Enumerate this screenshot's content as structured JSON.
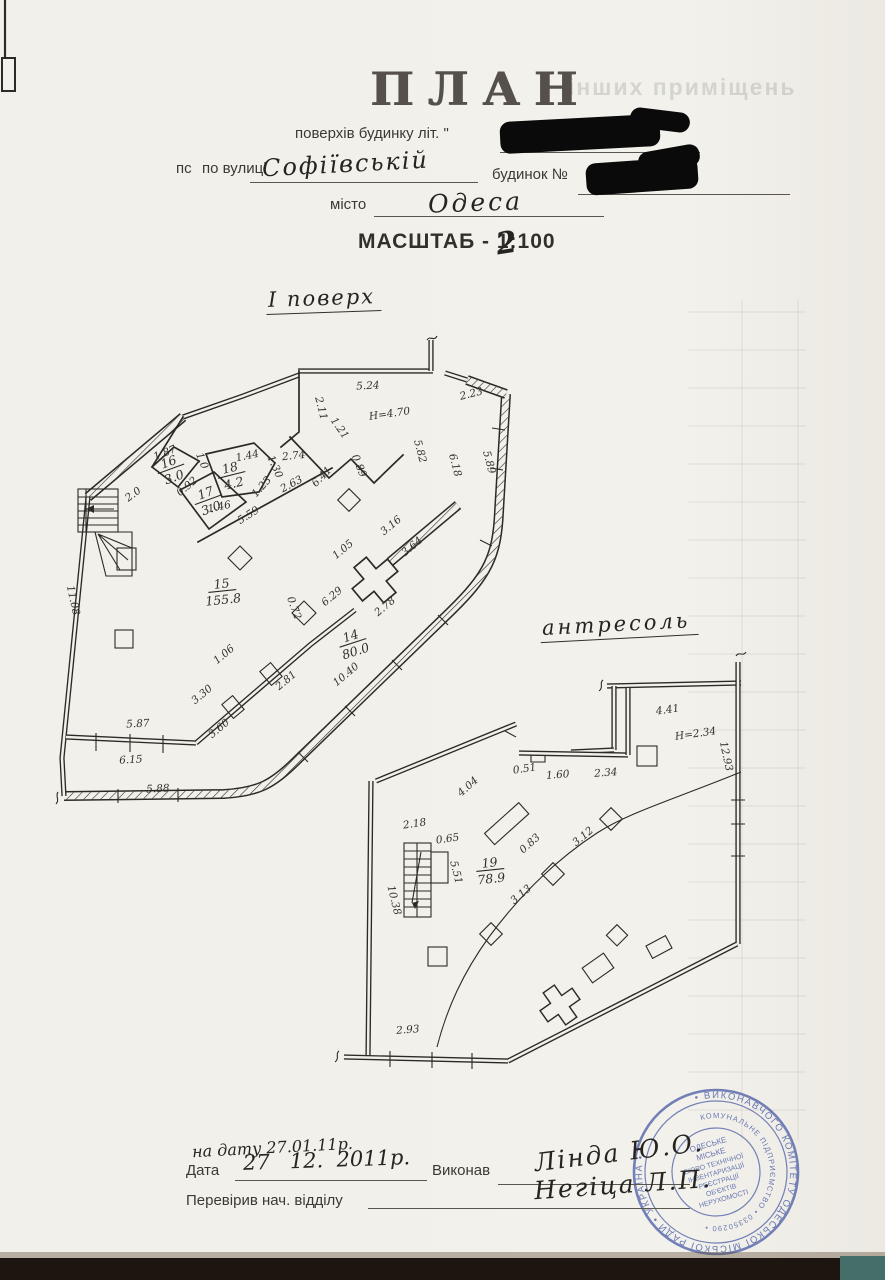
{
  "ink": "#2c2a26",
  "paper": "#f2f0ea",
  "header": {
    "title": "ПЛАН",
    "ghost_text": "інших приміщень",
    "line1_label": "поверхів будинку літ.  \"",
    "line2_prefix": "пс",
    "line2_label": "по вулиці",
    "street_value": "Софіївській",
    "line2_suffix": "будинок №",
    "line3_label": "місто",
    "city_value": "Одеса",
    "scale_prefix": "МАСШТАБ - 1:",
    "scale_digits": "100",
    "scale_overwrite": "2"
  },
  "plan1": {
    "caption": "І поверх",
    "height_note": "H=4.70",
    "labels": [
      {
        "t": "5.24",
        "x": 368,
        "y": 389,
        "r": -3
      },
      {
        "t": "H=4.70",
        "x": 390,
        "y": 417,
        "r": -8
      },
      {
        "t": "2.11",
        "x": 318,
        "y": 409,
        "r": 76
      },
      {
        "t": "1.21",
        "x": 337,
        "y": 430,
        "r": 55
      },
      {
        "t": "2.23",
        "x": 472,
        "y": 397,
        "r": -14
      },
      {
        "t": "5.82",
        "x": 417,
        "y": 452,
        "r": 75
      },
      {
        "t": "6.18",
        "x": 452,
        "y": 466,
        "r": 75
      },
      {
        "t": "5.89",
        "x": 486,
        "y": 463,
        "r": 75
      },
      {
        "t": "0.89",
        "x": 356,
        "y": 467,
        "r": 68
      },
      {
        "t": "2.74",
        "x": 294,
        "y": 459,
        "r": -6
      },
      {
        "t": "2.63",
        "x": 293,
        "y": 487,
        "r": -28
      },
      {
        "t": "6.41",
        "x": 324,
        "y": 479,
        "r": -46
      },
      {
        "t": "1.44",
        "x": 248,
        "y": 459,
        "r": -12
      },
      {
        "t": "1.23",
        "x": 264,
        "y": 489,
        "r": -48
      },
      {
        "t": "1.30",
        "x": 272,
        "y": 468,
        "r": 66
      },
      {
        "t": "1.87",
        "x": 166,
        "y": 456,
        "r": -22
      },
      {
        "t": "1.0",
        "x": 199,
        "y": 462,
        "r": 68
      },
      {
        "t": "0.92",
        "x": 189,
        "y": 489,
        "r": -40
      },
      {
        "t": "1.46",
        "x": 220,
        "y": 510,
        "r": -12
      },
      {
        "t": "5.59",
        "x": 250,
        "y": 518,
        "r": -32
      },
      {
        "t": "2.0",
        "x": 135,
        "y": 497,
        "r": -36
      },
      {
        "t": "3.16",
        "x": 393,
        "y": 528,
        "r": -40
      },
      {
        "t": "3.64",
        "x": 414,
        "y": 549,
        "r": -40
      },
      {
        "t": "1.05",
        "x": 345,
        "y": 552,
        "r": -40
      },
      {
        "t": "6.29",
        "x": 334,
        "y": 599,
        "r": -40
      },
      {
        "t": "0.72",
        "x": 291,
        "y": 609,
        "r": 70
      },
      {
        "t": "2.78",
        "x": 387,
        "y": 609,
        "r": -40
      },
      {
        "t": "1.06",
        "x": 226,
        "y": 657,
        "r": -40
      },
      {
        "t": "3.30",
        "x": 204,
        "y": 697,
        "r": -40
      },
      {
        "t": "3.60",
        "x": 221,
        "y": 731,
        "r": -40
      },
      {
        "t": "2.81",
        "x": 288,
        "y": 683,
        "r": -40
      },
      {
        "t": "10.40",
        "x": 348,
        "y": 677,
        "r": -40
      },
      {
        "t": "5.87",
        "x": 138,
        "y": 727,
        "r": -3
      },
      {
        "t": "6.15",
        "x": 131,
        "y": 763,
        "r": -3
      },
      {
        "t": "5.88",
        "x": 158,
        "y": 792,
        "r": -3
      },
      {
        "t": "11.08",
        "x": 70,
        "y": 601,
        "r": 78
      }
    ],
    "rooms": [
      {
        "num": "15",
        "area": "155.8",
        "x": 222,
        "y": 588,
        "r": -6
      },
      {
        "num": "14",
        "area": "80.0",
        "x": 352,
        "y": 640,
        "r": -18
      },
      {
        "num": "16",
        "area": "3.0",
        "x": 170,
        "y": 466,
        "r": -20
      },
      {
        "num": "18",
        "area": "4.2",
        "x": 231,
        "y": 472,
        "r": -14
      },
      {
        "num": "17",
        "area": "3.0",
        "x": 207,
        "y": 497,
        "r": -20
      }
    ]
  },
  "plan2": {
    "caption": "антресоль",
    "height_note": "H=2.34",
    "labels": [
      {
        "t": "4.41",
        "x": 668,
        "y": 713,
        "r": -8
      },
      {
        "t": "H=2.34",
        "x": 696,
        "y": 737,
        "r": -8
      },
      {
        "t": "12.93",
        "x": 723,
        "y": 757,
        "r": 78
      },
      {
        "t": "2.34",
        "x": 606,
        "y": 776,
        "r": -4
      },
      {
        "t": "1.60",
        "x": 558,
        "y": 778,
        "r": -4
      },
      {
        "t": "0.51",
        "x": 525,
        "y": 772,
        "r": -8
      },
      {
        "t": "4.04",
        "x": 470,
        "y": 789,
        "r": -42
      },
      {
        "t": "2.18",
        "x": 415,
        "y": 827,
        "r": -8
      },
      {
        "t": "0.65",
        "x": 448,
        "y": 842,
        "r": -8
      },
      {
        "t": "5.51",
        "x": 453,
        "y": 873,
        "r": 76
      },
      {
        "t": "10.38",
        "x": 391,
        "y": 901,
        "r": 76
      },
      {
        "t": "0.83",
        "x": 532,
        "y": 846,
        "r": -42
      },
      {
        "t": "3.12",
        "x": 585,
        "y": 839,
        "r": -40
      },
      {
        "t": "3.13",
        "x": 523,
        "y": 897,
        "r": -40
      },
      {
        "t": "2.93",
        "x": 408,
        "y": 1033,
        "r": -4
      }
    ],
    "rooms": [
      {
        "num": "19",
        "area": "78.9",
        "x": 490,
        "y": 867,
        "r": -6
      }
    ]
  },
  "footer": {
    "handnote": "на дату 27.01.11р.",
    "date_label": "Дата",
    "date_value": "27   12.  2011р.",
    "executor_label": "Виконав",
    "executor_value": "Лінда Ю.О.",
    "checked_label": "Перевірив нач. відділу",
    "checked_value": "Негіца Л.П."
  },
  "stamp": {
    "color": "#4054a2",
    "ring_outer": "• ВИКОНАВЧОГО КОМІТЕТУ ОДЕСЬКОЇ МІСЬКОЇ РАДИ • УКРАЇНА •",
    "ring_inner": "КОМУНАЛЬНЕ ПІДПРИЄМСТВО • 03350290 •",
    "center_lines": [
      "ОДЕСЬКЕ",
      "МІСЬКЕ",
      "БЮРО ТЕХНІЧНОЇ",
      "ІНВЕНТАРИЗАЦІЇ",
      "РЕЄСТРАЦІЇ",
      "ОБ'ЄКТІВ",
      "НЕРУХОМОСТІ"
    ]
  }
}
